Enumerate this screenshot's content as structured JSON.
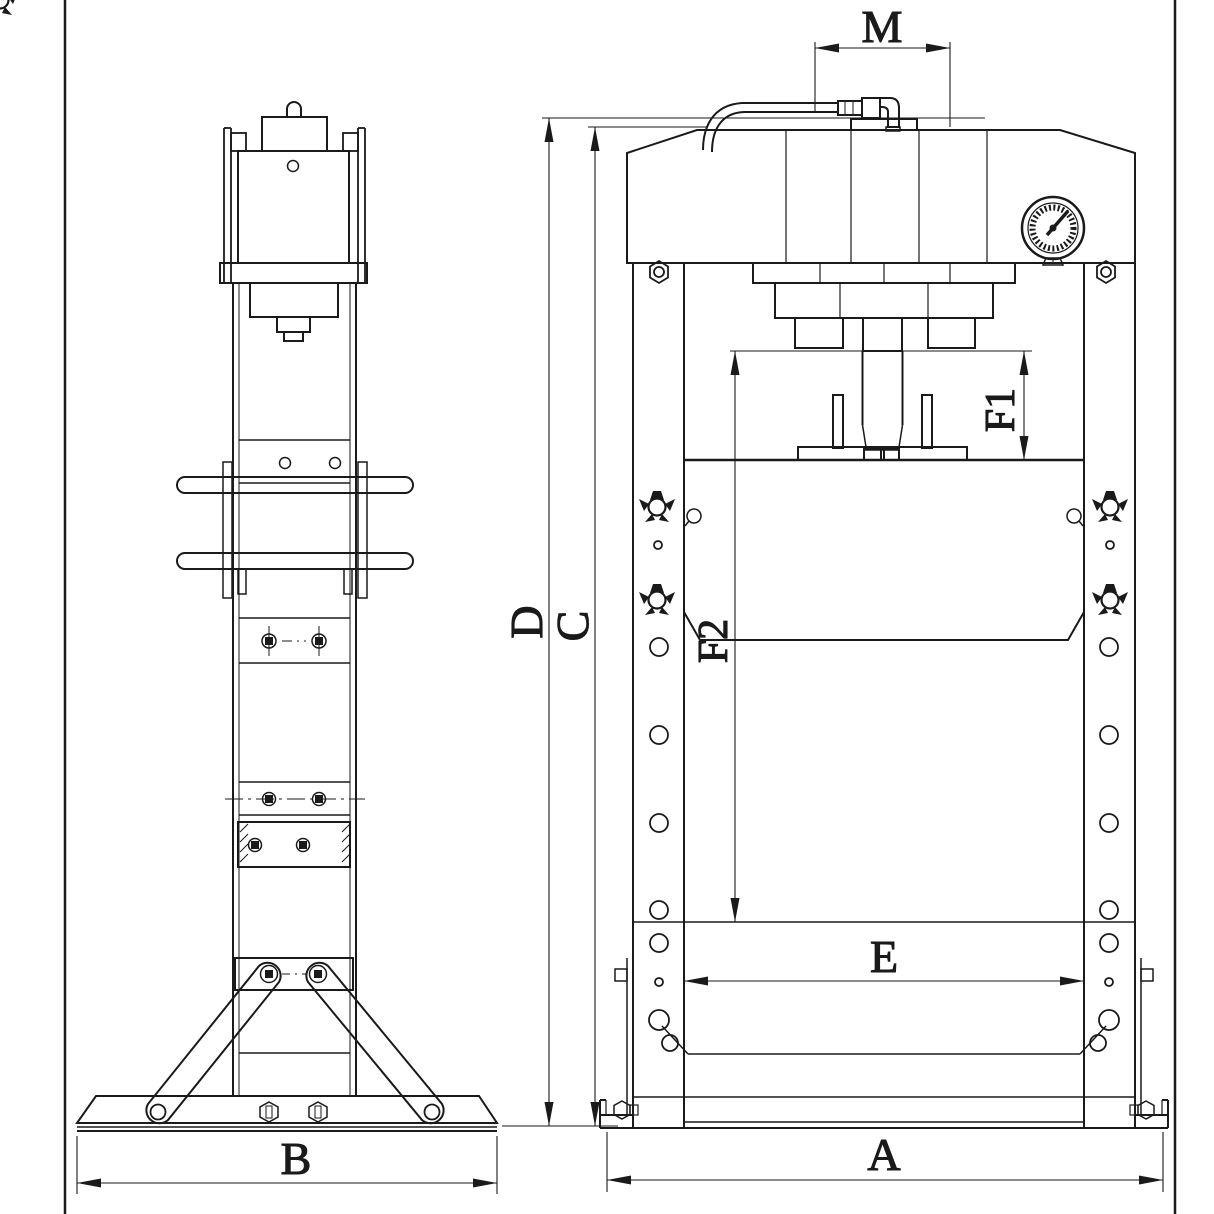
{
  "page": {
    "background": "#ffffff",
    "line_color": "#1a1a1a"
  },
  "drawing": {
    "subject": "hydraulic press two-view engineering drawing",
    "views": [
      "side-view",
      "front-view"
    ]
  },
  "dimensions": {
    "M": "M",
    "D": "D",
    "C": "C",
    "F1": "F1",
    "F2": "F2",
    "E": "E",
    "A": "A",
    "B": "B"
  }
}
